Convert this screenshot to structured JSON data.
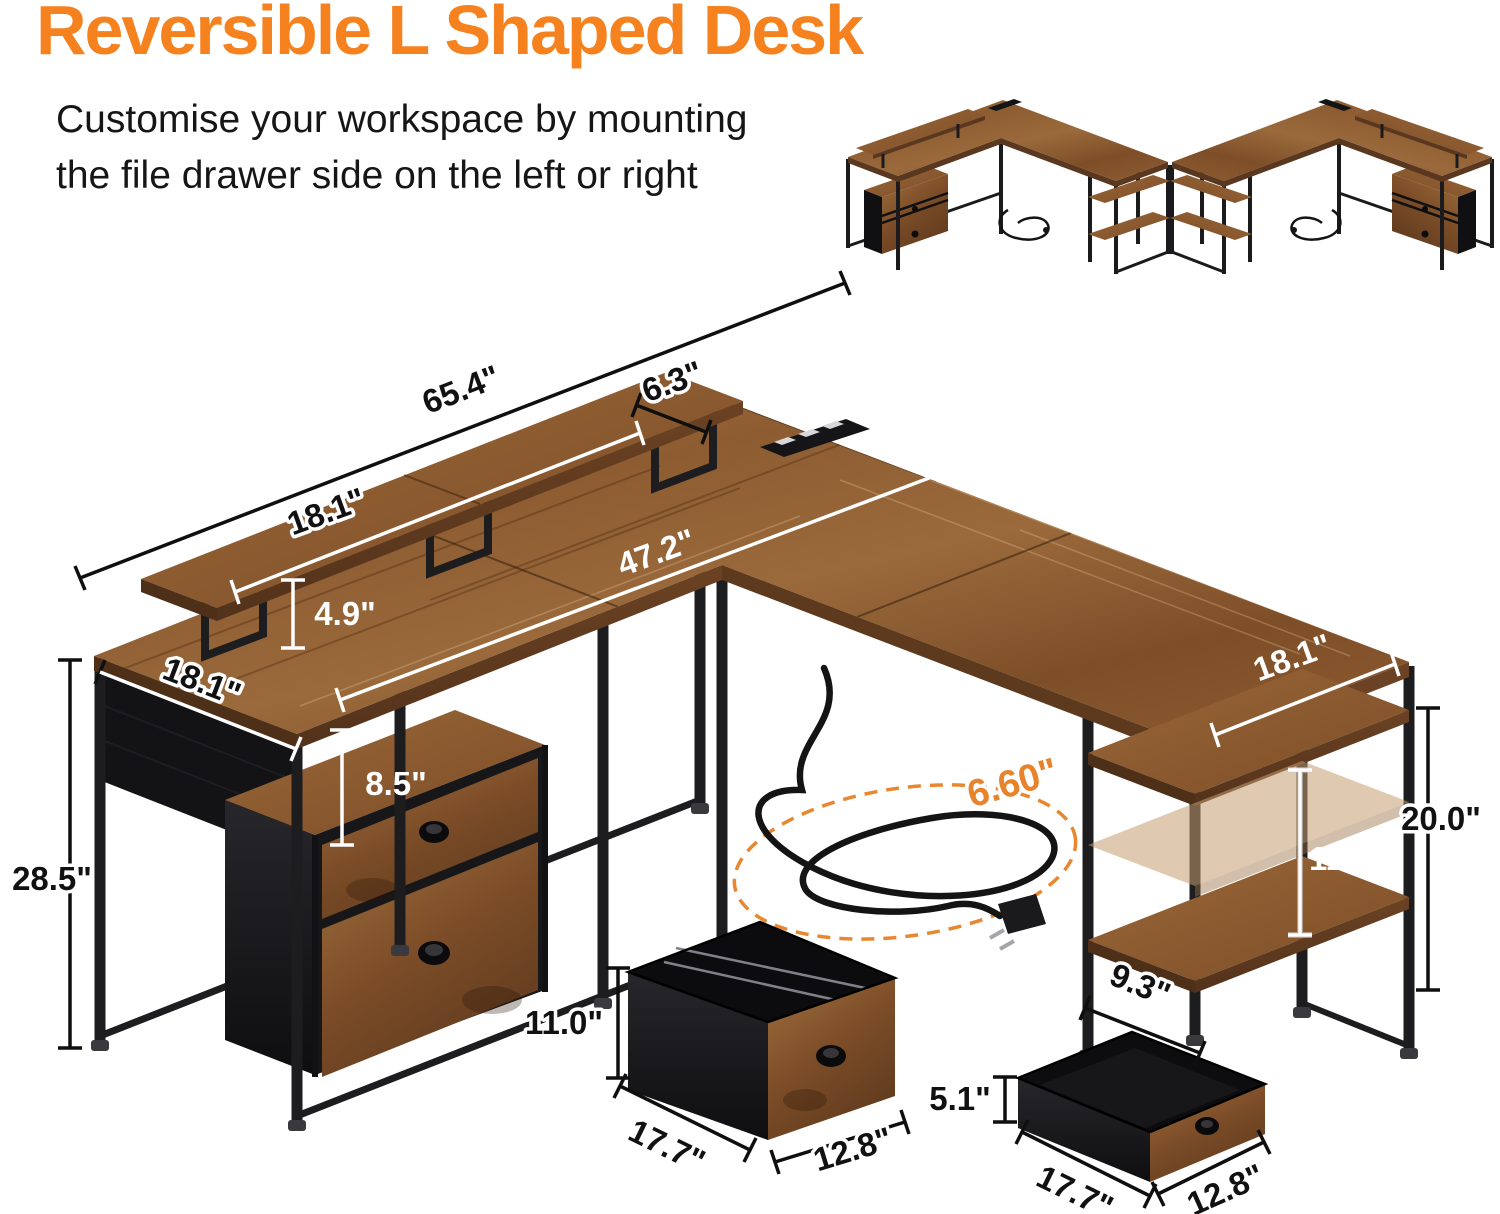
{
  "header": {
    "title": "Reversible L Shaped Desk",
    "subtitle_line1": "Customise your workspace by mounting",
    "subtitle_line2": "the file drawer side on the left or right"
  },
  "colors": {
    "title_orange": "#F5821F",
    "cord_accent_orange": "#E8832C",
    "dimension_label_dark": "#111111",
    "dimension_label_light": "#FFFFFF",
    "wood": "#8A5A32",
    "metal_frame": "#1D1D1F",
    "drawer_fabric": "#141417"
  },
  "dimensions": {
    "overall_width": "65.4\"",
    "corner_shelf_depth": "6.3\"",
    "monitor_shelf_length": "18.1\"",
    "monitor_shelf_height": "4.9\"",
    "main_desktop_length": "47.2\"",
    "desktop_depth": "18.1\"",
    "cabinet_clearance": "8.5\"",
    "desk_height": "28.5\"",
    "wing_desktop_depth": "18.1\"",
    "shelf_column_height": "20.0\"",
    "shelf_spacing": "11.7\"",
    "shelf_depth": "9.3\"",
    "power_cord_length": "6.60\"",
    "file_drawer": {
      "height": "11.0\"",
      "depth": "17.7\"",
      "width": "12.8\""
    },
    "top_drawer": {
      "height": "5.1\"",
      "depth": "17.7\"",
      "width": "12.8\""
    }
  }
}
